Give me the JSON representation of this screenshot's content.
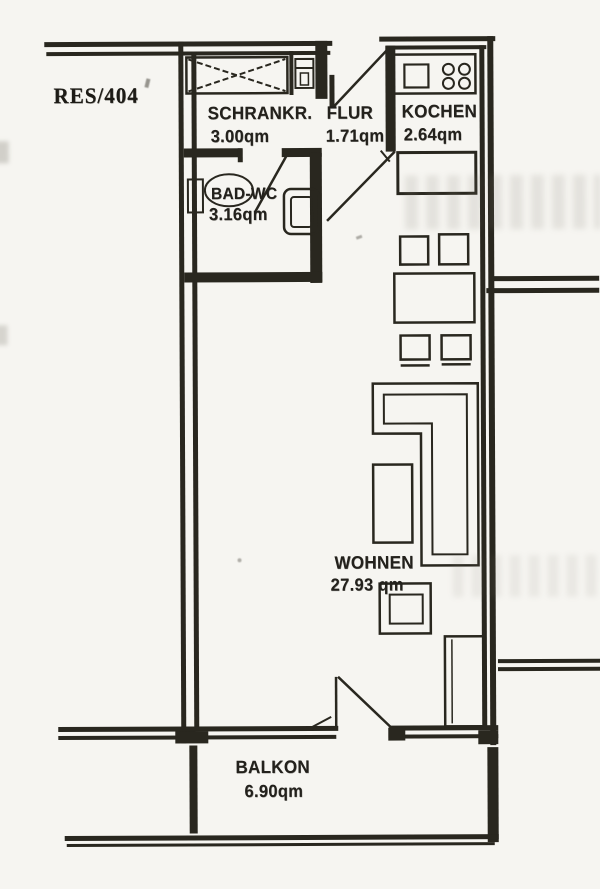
{
  "plan": {
    "id_label": "RES/404",
    "rooms": {
      "schrankraum": {
        "name": "SCHRANKR.",
        "area": "3.00qm"
      },
      "flur": {
        "name": "FLUR",
        "area": "1.71qm"
      },
      "kueche": {
        "name": "KOCHEN",
        "area": "2.64qm"
      },
      "bad": {
        "name": "BAD-WC",
        "area": "3.16qm"
      },
      "wohnen": {
        "name": "WOHNEN",
        "area": "27.93 qm"
      },
      "balkon": {
        "name": "BALKON",
        "area": "6.90qm"
      }
    },
    "symbols": [
      "crossed-closet-icon",
      "water-heater-icon",
      "kitchen-sink-icon",
      "four-burner-stove-icon",
      "washbasin-icon",
      "toilet-icon",
      "door-swing-icon",
      "l-sofa-icon",
      "dining-table-icon",
      "chair-icon",
      "coffee-table-icon",
      "stool-icon",
      "wardrobe-icon"
    ],
    "colors": {
      "ink": "#29271f",
      "paper": "#f6f5f1"
    }
  }
}
